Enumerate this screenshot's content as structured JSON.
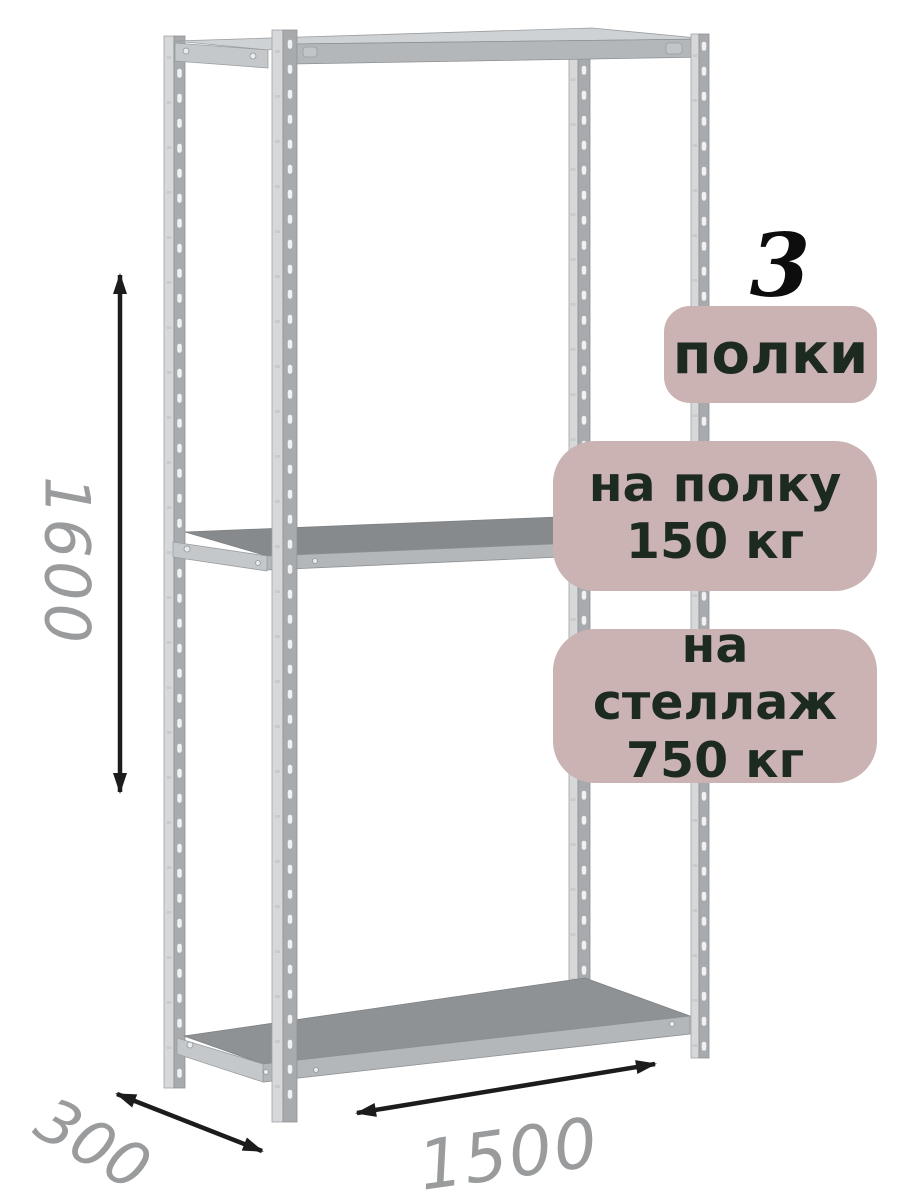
{
  "product": {
    "shelf_count": {
      "number": "3",
      "label": "полки"
    },
    "load_per_shelf": {
      "line1": "на полку",
      "line2": "150 кг"
    },
    "load_per_rack": {
      "line1": "на стеллаж",
      "line2": "750 кг"
    }
  },
  "dimensions": {
    "height": "1600",
    "depth": "300",
    "width": "1500"
  },
  "colors": {
    "badge_background": "#cab3b2",
    "badge_text": "#1d2a1f",
    "count_number": "#0d0d0d",
    "dimension_text": "#999b9d",
    "arrow": "#1c1c1c",
    "metal_light": "#d6d8da",
    "metal_post_dark": "#a8abae",
    "metal_beam": "#b4b7b9",
    "shelf_top": "#8f9294",
    "shelf_top_middle": "#868a8c"
  }
}
